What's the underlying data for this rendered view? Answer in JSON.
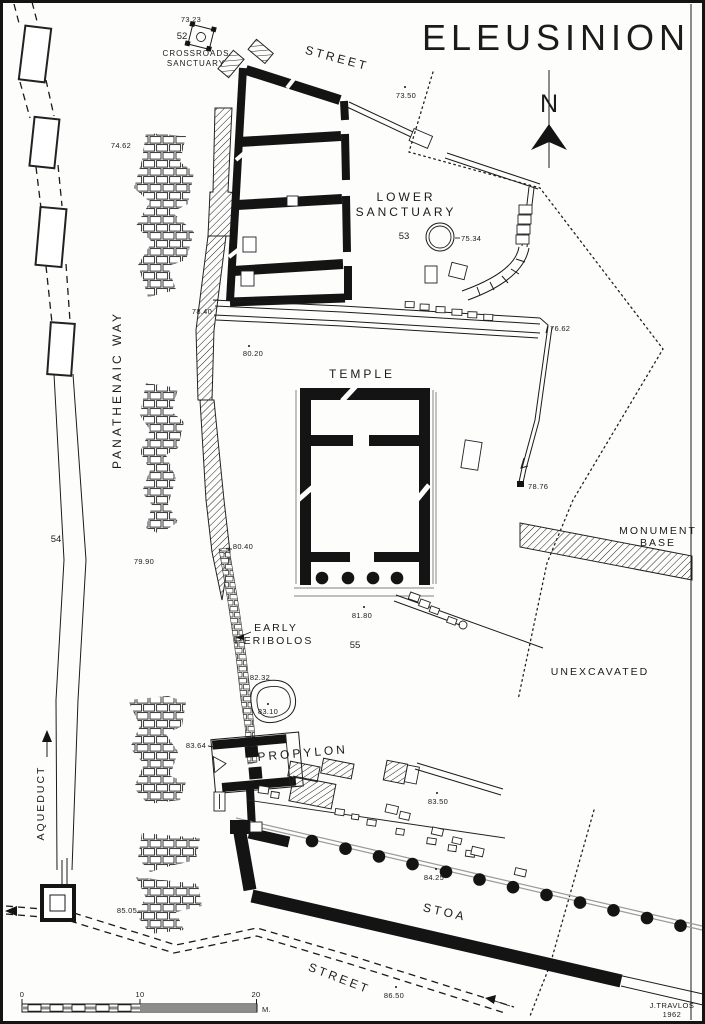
{
  "title": "ELEUSINION",
  "compass_n": "N",
  "labels": {
    "street_top": "STREET",
    "crossroads_1": "CROSSROADS",
    "crossroads_2": "SANCTUARY",
    "lower_1": "LOWER",
    "lower_2": "SANCTUARY",
    "temple": "TEMPLE",
    "panathenaic_way": "PANATHENAIC WAY",
    "monument_1": "MONUMENT",
    "monument_2": "BASE",
    "unexcavated": "UNEXCAVATED",
    "early_1": "EARLY",
    "early_2": "PERIBOLOS",
    "propylon": "PROPYLON",
    "aqueduct": "AQUEDUCT",
    "stoa": "STOA",
    "street_bottom": "STREET"
  },
  "site_numbers": {
    "crossroads_sanctuary": "52",
    "lower_sanctuary": "53",
    "aqueduct": "54",
    "courtyard": "55"
  },
  "elevations": {
    "crossroads": "73.23",
    "street_top": "73.50",
    "way_north": "74.62",
    "lower_sanctuary_well": "75.34",
    "drain_upper": "76.62",
    "way_terrace": "78.40",
    "drain_lower": "78.76",
    "way_mid": "79.90",
    "temple_terrace": "80.20",
    "peribolos_north": "80.40",
    "courtyard": "81.80",
    "peribolos_mid": "82.32",
    "pit": "83.10",
    "propylon_west": "83.64",
    "propylon_east": "83.50",
    "stoa": "84.25",
    "aqueduct_south": "85.05",
    "street_bottom": "86.50"
  },
  "scale_bar": {
    "start": "0",
    "middle": "10",
    "end": "20",
    "unit": "M."
  },
  "credit": {
    "author": "J.TRAVLOS",
    "year": "1962"
  },
  "colors": {
    "ink": "#1b1b1b",
    "paper": "#fdfdfc",
    "line_gray": "#9a9a9a"
  }
}
